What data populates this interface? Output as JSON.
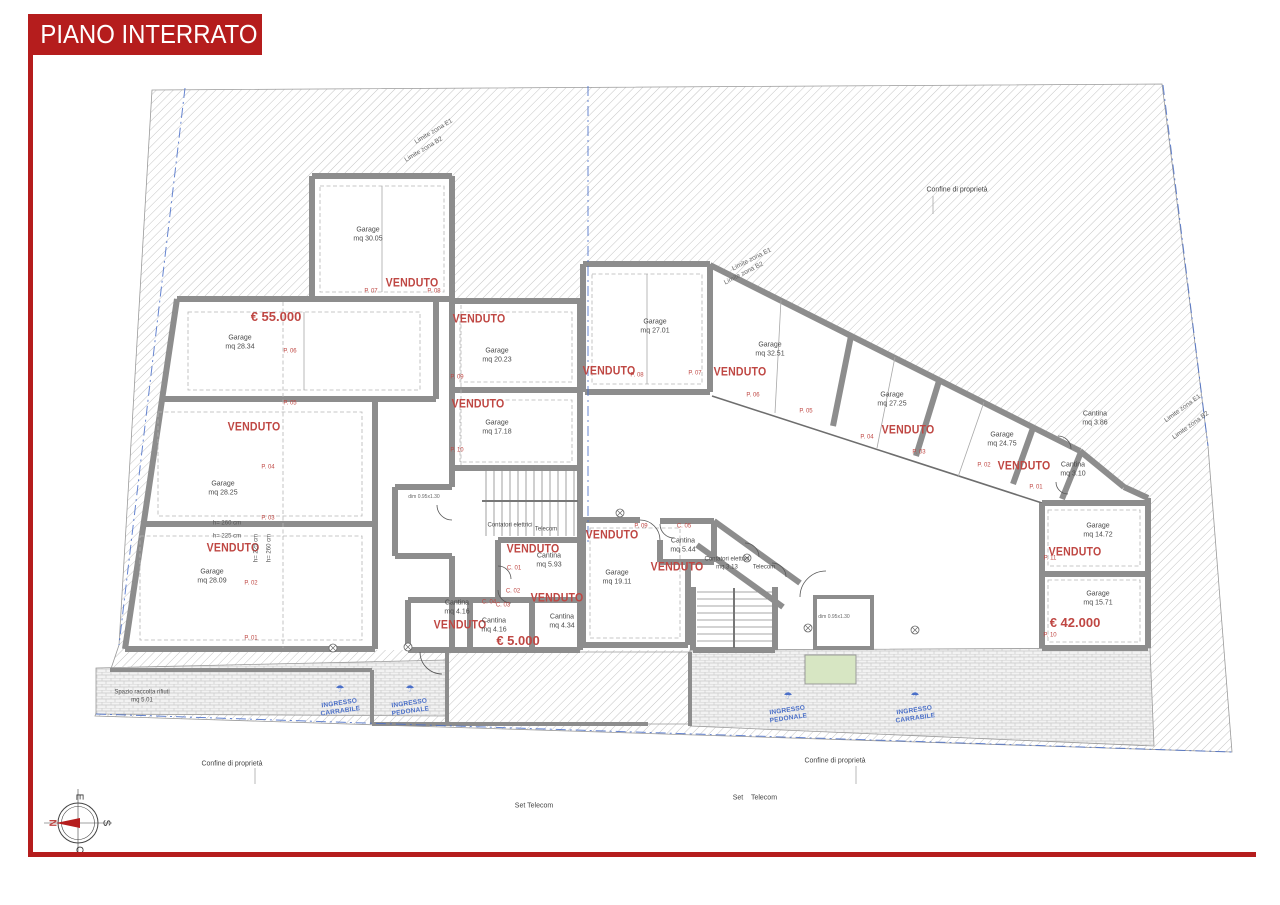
{
  "page": {
    "title": "PIANO INTERRATO"
  },
  "colors": {
    "banner_red": "#b51d1d",
    "label_red": "#bf4743",
    "blue": "#4a6fc8",
    "wall_gray": "#8d8d8d",
    "hatch_gray": "#c4c4c4",
    "brick_gray": "#cccccc",
    "planter_green": "#d7e6c3"
  },
  "plan": {
    "labels": [
      {
        "i": "price-label",
        "t": "€ 55.000",
        "x": 276,
        "y": 317,
        "c": "price"
      },
      {
        "i": "room-label-garage-28-34",
        "t": "Garage\nmq 28.34",
        "x": 240,
        "y": 343,
        "c": "room"
      },
      {
        "i": "parking-number",
        "t": "P. 06",
        "x": 290,
        "y": 352,
        "c": "pnum"
      },
      {
        "i": "parking-number",
        "t": "P. 05",
        "x": 290,
        "y": 404,
        "c": "pnum"
      },
      {
        "i": "venduto-label",
        "t": "VENDUTO",
        "x": 254,
        "y": 427,
        "c": "venduto"
      },
      {
        "i": "room-label-garage-28-25",
        "t": "Garage\nmq 28.25",
        "x": 223,
        "y": 489,
        "c": "room"
      },
      {
        "i": "parking-number",
        "t": "P. 04",
        "x": 268,
        "y": 468,
        "c": "pnum"
      },
      {
        "i": "parking-number",
        "t": "P. 03",
        "x": 268,
        "y": 519,
        "c": "pnum"
      },
      {
        "i": "height-note",
        "t": "h= 260 cm",
        "x": 227,
        "y": 524,
        "c": "dim"
      },
      {
        "i": "height-note",
        "t": "h= 225 cm",
        "x": 227,
        "y": 537,
        "c": "dim"
      },
      {
        "i": "venduto-label",
        "t": "VENDUTO",
        "x": 233,
        "y": 548,
        "c": "venduto"
      },
      {
        "i": "height-note",
        "t": "h= 225 cm",
        "x": 257,
        "y": 548,
        "c": "dim",
        "r": -90
      },
      {
        "i": "height-note",
        "t": "h= 260 cm",
        "x": 270,
        "y": 548,
        "c": "dim",
        "r": -90
      },
      {
        "i": "room-label-garage-28-09",
        "t": "Garage\nmq 28.09",
        "x": 212,
        "y": 577,
        "c": "room"
      },
      {
        "i": "parking-number",
        "t": "P. 02",
        "x": 251,
        "y": 584,
        "c": "pnum"
      },
      {
        "i": "parking-number",
        "t": "P. 01",
        "x": 251,
        "y": 639,
        "c": "pnum"
      },
      {
        "i": "room-label-garage-30-05",
        "t": "Garage\nmq 30.05",
        "x": 368,
        "y": 235,
        "c": "room"
      },
      {
        "i": "venduto-label",
        "t": "VENDUTO",
        "x": 412,
        "y": 283,
        "c": "venduto"
      },
      {
        "i": "parking-number",
        "t": "P. 07",
        "x": 371,
        "y": 292,
        "c": "pnum"
      },
      {
        "i": "parking-number",
        "t": "P. 08",
        "x": 434,
        "y": 292,
        "c": "pnum"
      },
      {
        "i": "venduto-label",
        "t": "VENDUTO",
        "x": 479,
        "y": 319,
        "c": "venduto"
      },
      {
        "i": "room-label-garage-20-23",
        "t": "Garage\nmq 20.23",
        "x": 497,
        "y": 356,
        "c": "room"
      },
      {
        "i": "parking-number",
        "t": "P. 09",
        "x": 457,
        "y": 378,
        "c": "pnum"
      },
      {
        "i": "venduto-label",
        "t": "VENDUTO",
        "x": 478,
        "y": 404,
        "c": "venduto"
      },
      {
        "i": "room-label-garage-17-18",
        "t": "Garage\nmq 17.18",
        "x": 497,
        "y": 428,
        "c": "room"
      },
      {
        "i": "parking-number",
        "t": "P. 10",
        "x": 457,
        "y": 451,
        "c": "pnum"
      },
      {
        "i": "room-label-garage-27-01",
        "t": "Garage\nmq 27.01",
        "x": 655,
        "y": 327,
        "c": "room"
      },
      {
        "i": "venduto-label",
        "t": "VENDUTO",
        "x": 609,
        "y": 371,
        "c": "venduto"
      },
      {
        "i": "parking-number",
        "t": "P. 08",
        "x": 637,
        "y": 376,
        "c": "pnum"
      },
      {
        "i": "parking-number",
        "t": "P. 07",
        "x": 695,
        "y": 374,
        "c": "pnum"
      },
      {
        "i": "room-label-garage-32-51",
        "t": "Garage\nmq 32.51",
        "x": 770,
        "y": 350,
        "c": "room"
      },
      {
        "i": "venduto-label",
        "t": "VENDUTO",
        "x": 740,
        "y": 372,
        "c": "venduto"
      },
      {
        "i": "parking-number",
        "t": "P. 06",
        "x": 753,
        "y": 396,
        "c": "pnum"
      },
      {
        "i": "parking-number",
        "t": "P. 05",
        "x": 806,
        "y": 412,
        "c": "pnum"
      },
      {
        "i": "room-label-garage-27-25",
        "t": "Garage\nmq 27.25",
        "x": 892,
        "y": 400,
        "c": "room"
      },
      {
        "i": "venduto-label",
        "t": "VENDUTO",
        "x": 908,
        "y": 430,
        "c": "venduto"
      },
      {
        "i": "parking-number",
        "t": "P. 04",
        "x": 867,
        "y": 438,
        "c": "pnum"
      },
      {
        "i": "parking-number",
        "t": "P. 03",
        "x": 919,
        "y": 453,
        "c": "pnum"
      },
      {
        "i": "room-label-garage-24-75",
        "t": "Garage\nmq 24.75",
        "x": 1002,
        "y": 440,
        "c": "room"
      },
      {
        "i": "venduto-label",
        "t": "VENDUTO",
        "x": 1024,
        "y": 466,
        "c": "venduto"
      },
      {
        "i": "parking-number",
        "t": "P. 02",
        "x": 984,
        "y": 466,
        "c": "pnum"
      },
      {
        "i": "parking-number",
        "t": "P. 01",
        "x": 1036,
        "y": 488,
        "c": "pnum"
      },
      {
        "i": "room-label-cantina-3-86",
        "t": "Cantina\nmq 3.86",
        "x": 1095,
        "y": 419,
        "c": "room"
      },
      {
        "i": "room-label-cantina-3-10",
        "t": "Cantina\nmq 3.10",
        "x": 1073,
        "y": 470,
        "c": "room"
      },
      {
        "i": "room-label-garage-14-72",
        "t": "Garage\nmq 14.72",
        "x": 1098,
        "y": 531,
        "c": "room"
      },
      {
        "i": "venduto-label",
        "t": "VENDUTO",
        "x": 1075,
        "y": 552,
        "c": "venduto"
      },
      {
        "i": "parking-number",
        "t": "P. 11",
        "x": 1050,
        "y": 559,
        "c": "pnum"
      },
      {
        "i": "room-label-garage-15-71",
        "t": "Garage\nmq 15.71",
        "x": 1098,
        "y": 599,
        "c": "room"
      },
      {
        "i": "price-label",
        "t": "€ 42.000",
        "x": 1075,
        "y": 623,
        "c": "price"
      },
      {
        "i": "parking-number",
        "t": "P. 10",
        "x": 1050,
        "y": 636,
        "c": "pnum"
      },
      {
        "i": "venduto-label",
        "t": "VENDUTO",
        "x": 612,
        "y": 535,
        "c": "venduto"
      },
      {
        "i": "room-label-garage-19-11",
        "t": "Garage\nmq 19.11",
        "x": 617,
        "y": 578,
        "c": "room"
      },
      {
        "i": "parking-number",
        "t": "P. 09",
        "x": 641,
        "y": 527,
        "c": "pnum"
      },
      {
        "i": "cantina-number",
        "t": "C. 05",
        "x": 684,
        "y": 527,
        "c": "pnum"
      },
      {
        "i": "room-label-cantina-5-44",
        "t": "Cantina\nmq 5.44",
        "x": 683,
        "y": 546,
        "c": "room"
      },
      {
        "i": "venduto-label",
        "t": "VENDUTO",
        "x": 677,
        "y": 567,
        "c": "venduto"
      },
      {
        "i": "room-label-contatori",
        "t": "Contatori elettrici\nmq 3.13",
        "x": 727,
        "y": 564,
        "c": "roomsm"
      },
      {
        "i": "room-label-telecom",
        "t": "Telecom",
        "x": 764,
        "y": 568,
        "c": "roomsm"
      },
      {
        "i": "room-label-contatori",
        "t": "Contatori elettrici",
        "x": 510,
        "y": 526,
        "c": "roomsm"
      },
      {
        "i": "room-label-telecom",
        "t": "Telecom",
        "x": 546,
        "y": 530,
        "c": "roomsm"
      },
      {
        "i": "venduto-label",
        "t": "VENDUTO",
        "x": 533,
        "y": 549,
        "c": "venduto"
      },
      {
        "i": "room-label-cantina-5-93",
        "t": "Cantina\nmq 5.93",
        "x": 549,
        "y": 561,
        "c": "room"
      },
      {
        "i": "cantina-number",
        "t": "C. 01",
        "x": 514,
        "y": 569,
        "c": "pnum"
      },
      {
        "i": "cantina-number",
        "t": "C. 02",
        "x": 513,
        "y": 592,
        "c": "pnum"
      },
      {
        "i": "venduto-label",
        "t": "VENDUTO",
        "x": 557,
        "y": 598,
        "c": "venduto"
      },
      {
        "i": "cantina-number",
        "t": "C. 04",
        "x": 489,
        "y": 603,
        "c": "pnum"
      },
      {
        "i": "cantina-number",
        "t": "C. 03",
        "x": 503,
        "y": 606,
        "c": "pnum"
      },
      {
        "i": "room-label-cantina-4-16",
        "t": "Cantina\nmq 4.16",
        "x": 457,
        "y": 608,
        "c": "room"
      },
      {
        "i": "venduto-label",
        "t": "VENDUTO",
        "x": 460,
        "y": 625,
        "c": "venduto"
      },
      {
        "i": "room-label-cantina-4-16",
        "t": "Cantina\nmq 4.16",
        "x": 494,
        "y": 626,
        "c": "room"
      },
      {
        "i": "price-label",
        "t": "€ 5.000",
        "x": 518,
        "y": 641,
        "c": "price"
      },
      {
        "i": "room-label-cantina-4-34",
        "t": "Cantina\nmq 4.34",
        "x": 562,
        "y": 622,
        "c": "room"
      },
      {
        "i": "note-label",
        "t": "Spazio raccolta rifiuti\nmq 5.01",
        "x": 142,
        "y": 697,
        "c": "roomsm"
      },
      {
        "i": "elevator-dim-label",
        "t": "dim 0.95x1.30",
        "x": 424,
        "y": 497,
        "c": "dimxs"
      },
      {
        "i": "elevator-dim-label",
        "t": "dim 0.95x1.30",
        "x": 834,
        "y": 617,
        "c": "dimxs"
      },
      {
        "i": "entrance-icon",
        "t": "☂",
        "x": 340,
        "y": 690,
        "c": "blueico"
      },
      {
        "i": "entrance-label-carrabile",
        "t": "INGRESSO\nCARRABILE",
        "x": 340,
        "y": 708,
        "c": "blue",
        "r": -8
      },
      {
        "i": "entrance-icon",
        "t": "☂",
        "x": 410,
        "y": 690,
        "c": "blueico"
      },
      {
        "i": "entrance-label-pedonale",
        "t": "INGRESSO\nPEDONALE",
        "x": 410,
        "y": 708,
        "c": "blue",
        "r": -8
      },
      {
        "i": "entrance-icon",
        "t": "☂",
        "x": 788,
        "y": 697,
        "c": "blueico"
      },
      {
        "i": "entrance-label-pedonale",
        "t": "INGRESSO\nPEDONALE",
        "x": 788,
        "y": 715,
        "c": "blue",
        "r": -8
      },
      {
        "i": "entrance-icon",
        "t": "☂",
        "x": 915,
        "y": 697,
        "c": "blueico"
      },
      {
        "i": "entrance-label-carrabile",
        "t": "INGRESSO\nCARRABILE",
        "x": 915,
        "y": 715,
        "c": "blue",
        "r": -8
      },
      {
        "i": "property-line-label",
        "t": "Confine di proprietà",
        "x": 957,
        "y": 191,
        "c": "note"
      },
      {
        "i": "property-line-label",
        "t": "Confine di proprietà",
        "x": 835,
        "y": 762,
        "c": "note"
      },
      {
        "i": "property-line-label",
        "t": "Confine di proprietà",
        "x": 232,
        "y": 765,
        "c": "note"
      },
      {
        "i": "zone-limit-label",
        "t": "Limite zona E1",
        "x": 434,
        "y": 132,
        "c": "zona",
        "r": -31
      },
      {
        "i": "zone-limit-label",
        "t": "Limite zona B2",
        "x": 424,
        "y": 150,
        "c": "zona",
        "r": -31
      },
      {
        "i": "zone-limit-label",
        "t": "Limite zona E1",
        "x": 752,
        "y": 260,
        "c": "zona",
        "r": -27
      },
      {
        "i": "zone-limit-label",
        "t": "Limite zona B2",
        "x": 744,
        "y": 274,
        "c": "zona",
        "r": -27
      },
      {
        "i": "zone-limit-label",
        "t": "Limite zona E1",
        "x": 1183,
        "y": 409,
        "c": "zona",
        "r": -36
      },
      {
        "i": "zone-limit-label",
        "t": "Limite zona B2",
        "x": 1191,
        "y": 426,
        "c": "zona",
        "r": -36
      },
      {
        "i": "note-label",
        "t": "Set Telecom",
        "x": 534,
        "y": 807,
        "c": "note"
      },
      {
        "i": "note-label",
        "t": "Set",
        "x": 738,
        "y": 799,
        "c": "note"
      },
      {
        "i": "note-label",
        "t": "Telecom",
        "x": 764,
        "y": 799,
        "c": "note"
      },
      {
        "i": "compass-letter-e",
        "t": "E",
        "x": 78,
        "y": 797,
        "c": "compass",
        "r": 90
      },
      {
        "i": "compass-letter-n",
        "t": "N",
        "x": 51,
        "y": 823,
        "c": "compassN",
        "r": 90
      },
      {
        "i": "compass-letter-s",
        "t": "S",
        "x": 105,
        "y": 823,
        "c": "compass",
        "r": 90
      },
      {
        "i": "compass-letter-o",
        "t": "O",
        "x": 78,
        "y": 850,
        "c": "compass",
        "r": 90
      }
    ]
  }
}
